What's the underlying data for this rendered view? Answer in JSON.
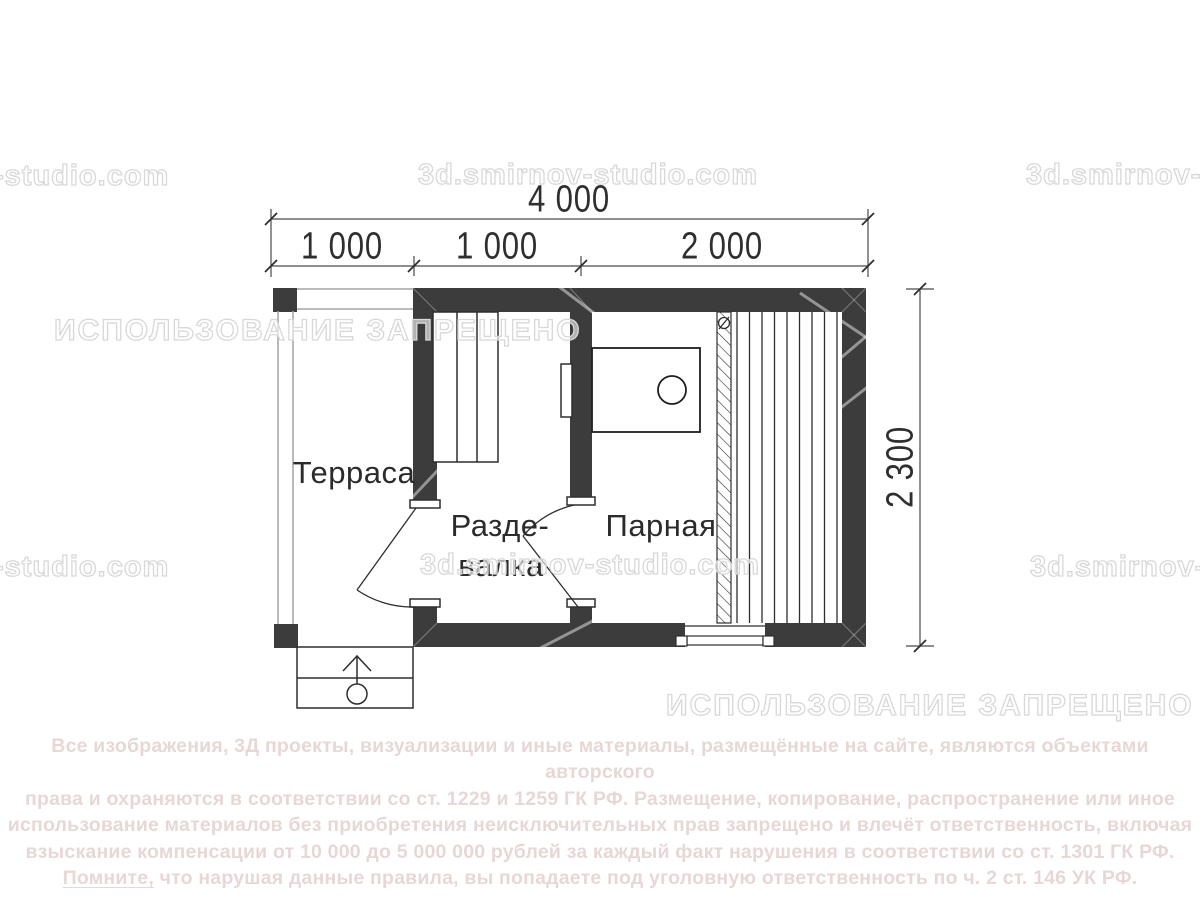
{
  "plan": {
    "rooms": {
      "terrace": "Терраса",
      "dressing_line1": "Разде-",
      "dressing_line2": "валка",
      "steam": "Парная"
    },
    "dimensions": {
      "total": "4 000",
      "seg_terrace": "1 000",
      "seg_dressing": "1 000",
      "seg_steam": "2 000",
      "depth": "2 300"
    },
    "colors": {
      "wall": "#3c3c3c",
      "line": "#2e2e2e"
    }
  },
  "watermarks": {
    "brand_full": "3d.smirnov-studio.com",
    "brand_partial_left": "-studio.com",
    "forbidden": "ИСПОЛЬЗОВАНИЕ ЗАПРЕЩЕНО"
  },
  "copyright": {
    "line1": "Все изображения, 3Д проекты, визуализации и иные материалы, размещённые на сайте, являются объектами авторского",
    "line2": "права и охраняются в соответствии со ст. 1229 и 1259 ГК РФ. Размещение, копирование, распространение или иное",
    "line3": "использование материалов без приобретения неисключительных прав запрещено и влечёт ответственность, включая",
    "line4": "взыскание компенсации от 10 000 до 5 000 000 рублей за каждый факт нарушения в соответствии со ст. 1301 ГК РФ.",
    "line5_emphasis": "Помните,",
    "line5_rest": " что нарушая данные правила, вы попадаете под уголовную ответственность по ч. 2 ст. 146 УК РФ."
  }
}
